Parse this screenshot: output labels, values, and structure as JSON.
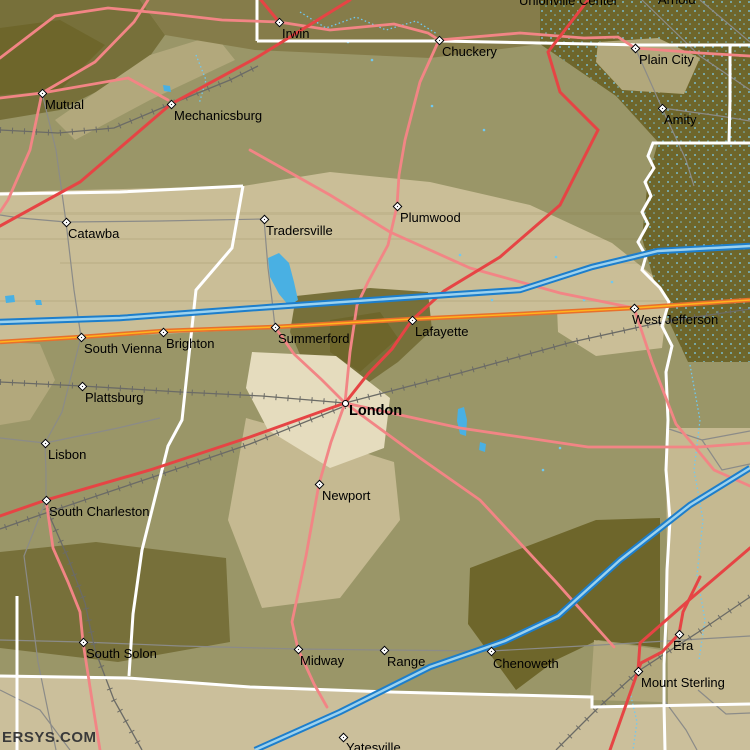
{
  "watermark": "ERSYS.COM",
  "towns": [
    {
      "name": "Irwin",
      "x": 279,
      "y": 22,
      "marker": "diamond",
      "label_x": 282,
      "label_y": 27
    },
    {
      "name": "Chuckery",
      "x": 439,
      "y": 40,
      "marker": "diamond",
      "label_x": 442,
      "label_y": 45
    },
    {
      "name": "Unionville Center",
      "x": null,
      "y": null,
      "marker": "none",
      "label_x": 519,
      "label_y": -6
    },
    {
      "name": "Arnold",
      "x": null,
      "y": null,
      "marker": "none",
      "label_x": 658,
      "label_y": -7
    },
    {
      "name": "Plain City",
      "x": 635,
      "y": 48,
      "marker": "diamond",
      "label_x": 639,
      "label_y": 53
    },
    {
      "name": "Amity",
      "x": 662,
      "y": 108,
      "marker": "diamond",
      "label_x": 664,
      "label_y": 113
    },
    {
      "name": "Mutual",
      "x": 42,
      "y": 93,
      "marker": "diamond",
      "label_x": 45,
      "label_y": 98
    },
    {
      "name": "Mechanicsburg",
      "x": 171,
      "y": 104,
      "marker": "diamond",
      "label_x": 174,
      "label_y": 109
    },
    {
      "name": "Catawba",
      "x": 66,
      "y": 222,
      "marker": "diamond",
      "label_x": 68,
      "label_y": 227
    },
    {
      "name": "Tradersville",
      "x": 264,
      "y": 219,
      "marker": "diamond",
      "label_x": 266,
      "label_y": 224
    },
    {
      "name": "Plumwood",
      "x": 397,
      "y": 206,
      "marker": "diamond",
      "label_x": 400,
      "label_y": 211
    },
    {
      "name": "South Vienna",
      "x": 81,
      "y": 337,
      "marker": "diamond",
      "label_x": 84,
      "label_y": 342
    },
    {
      "name": "Brighton",
      "x": 163,
      "y": 332,
      "marker": "diamond",
      "label_x": 166,
      "label_y": 337
    },
    {
      "name": "Plattsburg",
      "x": 82,
      "y": 386,
      "marker": "diamond",
      "label_x": 85,
      "label_y": 391
    },
    {
      "name": "Summerford",
      "x": 275,
      "y": 327,
      "marker": "diamond",
      "label_x": 278,
      "label_y": 332
    },
    {
      "name": "Lafayette",
      "x": 412,
      "y": 320,
      "marker": "diamond",
      "label_x": 415,
      "label_y": 325
    },
    {
      "name": "London",
      "x": 345,
      "y": 403,
      "marker": "circle",
      "bold": true,
      "label_x": 349,
      "label_y": 404
    },
    {
      "name": "West Jefferson",
      "x": 634,
      "y": 308,
      "marker": "diamond",
      "label_x": 632,
      "label_y": 313
    },
    {
      "name": "Newport",
      "x": 319,
      "y": 484,
      "marker": "diamond",
      "label_x": 322,
      "label_y": 489
    },
    {
      "name": "Lisbon",
      "x": 45,
      "y": 443,
      "marker": "diamond",
      "label_x": 48,
      "label_y": 448
    },
    {
      "name": "South Charleston",
      "x": 46,
      "y": 500,
      "marker": "diamond",
      "label_x": 49,
      "label_y": 505
    },
    {
      "name": "South Solon",
      "x": 83,
      "y": 642,
      "marker": "diamond",
      "label_x": 86,
      "label_y": 647
    },
    {
      "name": "Midway",
      "x": 298,
      "y": 649,
      "marker": "diamond",
      "label_x": 300,
      "label_y": 654
    },
    {
      "name": "Range",
      "x": 384,
      "y": 650,
      "marker": "diamond",
      "label_x": 387,
      "label_y": 655
    },
    {
      "name": "Chenoweth",
      "x": 491,
      "y": 651,
      "marker": "diamond",
      "label_x": 493,
      "label_y": 657
    },
    {
      "name": "Era",
      "x": 679,
      "y": 634,
      "marker": "diamond",
      "label_x": 673,
      "label_y": 639
    },
    {
      "name": "Mount Sterling",
      "x": 638,
      "y": 671,
      "marker": "diamond",
      "label_x": 641,
      "label_y": 676
    },
    {
      "name": "Yatesville",
      "x": 343,
      "y": 737,
      "marker": "diamond",
      "label_x": 346,
      "label_y": 741
    }
  ],
  "colors": {
    "road_pink": "#f28585",
    "road_red": "#e64444",
    "us_route_outer": "#e8702b",
    "us_route_inner": "#ffb41e",
    "interstate_outer": "#1d7ecb",
    "interstate_inner": "#9cd2ee",
    "road_gray": "#8b8b88",
    "railroad": "#6b6b66",
    "boundary_white": "#ffffff",
    "stream": "#6fc9f2",
    "water": "#49b0e3",
    "terrain_base": "#9a9668",
    "terrain_olive": "#857c4a",
    "terrain_dark": "#6e662b",
    "terrain_dark2": "#77703a",
    "terrain_pale": "#cabe97",
    "terrain_khaki": "#b2a87c",
    "terrain_cream": "#e5dcbe",
    "terrain_tan": "#cbbf9b",
    "terrain_tan2": "#c5b991",
    "label": "#000000",
    "watermark": "#3a3a3a"
  }
}
